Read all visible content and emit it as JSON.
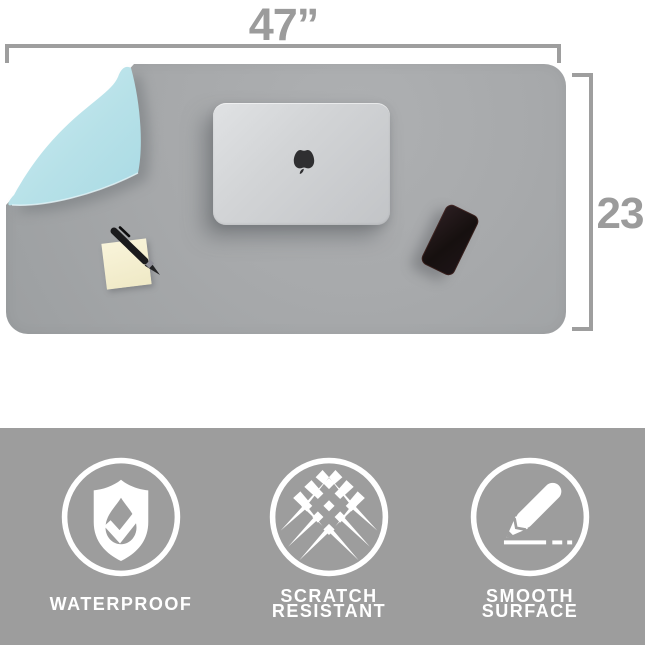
{
  "dimensions": {
    "width_label": "47”",
    "height_label": "23"
  },
  "scene": {
    "objects": [
      "desk-mat",
      "flipped-corner-flap",
      "macbook-laptop",
      "apple-logo",
      "smartphone",
      "sticky-note-pad",
      "pen"
    ]
  },
  "features": [
    {
      "icon": "shield-water-drop-check-icon",
      "label_line1": "WATERPROOF",
      "label_line2": ""
    },
    {
      "icon": "scratch-marks-icon",
      "label_line1": "SCRATCH",
      "label_line2": "RESISTANT"
    },
    {
      "icon": "pencil-drawing-line-icon",
      "label_line1": "SMOOTH",
      "label_line2": "SURFACE"
    }
  ],
  "colors": {
    "dimension_gray": "#9b9b9b",
    "mat_gray": "#a7a9ab",
    "flap_blue": "#b7e1e8",
    "banner_gray": "#9d9d9d",
    "icon_white": "#ffffff",
    "note_yellow": "#f6f1d2",
    "laptop_silver": "#d2d4d6",
    "phone_black": "#16100f"
  }
}
